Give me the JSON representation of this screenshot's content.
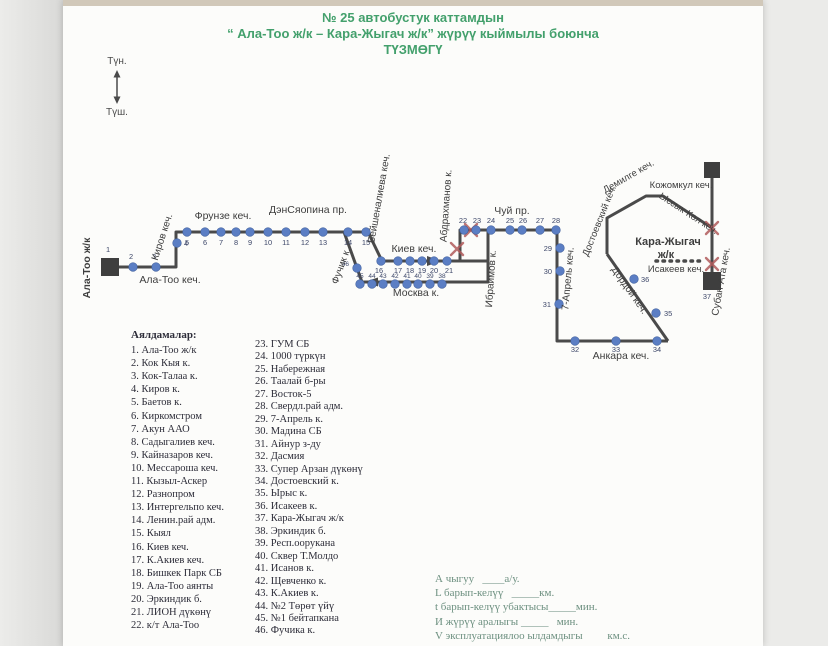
{
  "title": {
    "line1": "№ 25  автобустук каттамдын",
    "line2": "“ Ала-Тоо ж/к – Кара-Жыгач ж/к” жүрүү кыймылы боюнча",
    "line3": "ТҮЗМӨГҮ"
  },
  "compass": {
    "north": "Түн.",
    "south": "Түш."
  },
  "map": {
    "line_color": "#4a4a4a",
    "stop_fill": "#5b7ec4",
    "stop_stroke": "#41619e",
    "x_color": "#b05a5a",
    "number_color": "#3c4668",
    "label_color": "#3e3e3e",
    "routes": [
      "110,267 176,267 176,232 368,232 382,261 488,261",
      "460,261 460,230 557,230 557,341 668,341",
      "488,230 488,282 362,282 344,232",
      "668,341 607,254",
      "607,254 607,218 646,196 663,196 712,228",
      "712,176 712,281"
    ],
    "dashed": "656,261 704,261",
    "squares": [
      [
        101,
        258,
        18
      ],
      [
        704,
        162,
        16
      ],
      [
        703,
        272,
        18
      ]
    ],
    "arrows": [
      "427,256 427,266 441,261",
      "378,277.5 378,286.5 364,282"
    ],
    "xmarks": [
      [
        457,
        249
      ],
      [
        471,
        230
      ],
      [
        712,
        228
      ],
      [
        712,
        264
      ]
    ],
    "stops": [
      [
        2,
        133,
        267,
        131,
        259,
        "m"
      ],
      [
        3,
        156,
        267,
        154,
        259,
        "m"
      ],
      [
        4,
        177,
        243,
        184,
        246,
        "s"
      ],
      [
        5,
        187,
        232,
        187,
        245,
        "m"
      ],
      [
        6,
        205,
        232,
        205,
        245,
        "m"
      ],
      [
        7,
        221,
        232,
        221,
        245,
        "m"
      ],
      [
        8,
        236,
        232,
        236,
        245,
        "m"
      ],
      [
        9,
        250,
        232,
        250,
        245,
        "m"
      ],
      [
        10,
        268,
        232,
        268,
        245,
        "m"
      ],
      [
        11,
        286,
        232,
        286,
        245,
        "m"
      ],
      [
        12,
        305,
        232,
        305,
        245,
        "m"
      ],
      [
        13,
        323,
        232,
        323,
        245,
        "m"
      ],
      [
        14,
        348,
        232,
        348,
        245,
        "m"
      ],
      [
        15,
        366,
        232,
        366,
        245,
        "m"
      ],
      [
        16,
        381,
        261,
        379,
        273,
        "m"
      ],
      [
        17,
        398,
        261,
        398,
        273,
        "m"
      ],
      [
        18,
        410,
        261,
        410,
        273,
        "m"
      ],
      [
        19,
        422,
        261,
        422,
        273,
        "m"
      ],
      [
        20,
        434,
        261,
        434,
        273,
        "m"
      ],
      [
        21,
        447,
        261,
        449,
        273,
        "m"
      ],
      [
        22,
        464,
        230,
        463,
        223,
        "m"
      ],
      [
        23,
        476,
        230,
        477,
        223,
        "m"
      ],
      [
        24,
        491,
        230,
        491,
        223,
        "m"
      ],
      [
        25,
        510,
        230,
        510,
        223,
        "m"
      ],
      [
        26,
        522,
        230,
        523,
        223,
        "m"
      ],
      [
        27,
        540,
        230,
        540,
        223,
        "m"
      ],
      [
        28,
        556,
        230,
        556,
        223,
        "m"
      ],
      [
        29,
        560,
        248,
        552,
        251,
        "e"
      ],
      [
        30,
        560,
        271,
        552,
        274,
        "e"
      ],
      [
        31,
        559,
        304,
        551,
        307,
        "e"
      ],
      [
        32,
        575,
        341,
        575,
        352,
        "m"
      ],
      [
        33,
        616,
        341,
        616,
        352,
        "m"
      ],
      [
        34,
        657,
        341,
        657,
        352,
        "m"
      ],
      [
        35,
        656,
        313,
        664,
        316,
        "s"
      ],
      [
        36,
        634,
        279,
        641,
        282,
        "s"
      ],
      [
        38,
        442,
        284,
        442,
        278,
        "m",
        6.5
      ],
      [
        39,
        430,
        284,
        430,
        278,
        "m",
        6.5
      ],
      [
        40,
        418,
        284,
        418,
        278,
        "m",
        6.5
      ],
      [
        41,
        407,
        284,
        407,
        278,
        "m",
        6.5
      ],
      [
        42,
        395,
        284,
        395,
        278,
        "m",
        6.5
      ],
      [
        43,
        383,
        284,
        383,
        278,
        "m",
        6.5
      ],
      [
        44,
        372,
        284,
        372,
        278,
        "m",
        6.5
      ],
      [
        45,
        360,
        284,
        360,
        278,
        "m",
        6.5
      ],
      [
        46,
        357,
        268,
        349,
        266,
        "e",
        6.5
      ]
    ],
    "terminal_numbers": [
      [
        1,
        108,
        252
      ],
      [
        37,
        707,
        299
      ]
    ],
    "street_labels": [
      [
        "Ала-Тоо ж/к",
        90,
        268,
        -90,
        10.5,
        1
      ],
      [
        "Ала-Тоо кеч.",
        170,
        283,
        0,
        10.5,
        0
      ],
      [
        "Киров кеч.",
        165,
        238,
        -72,
        10,
        0
      ],
      [
        "Фрунзе кеч.",
        223,
        219,
        0,
        10.5,
        0
      ],
      [
        "ДэнСяопина пр.",
        308,
        213,
        0,
        10.5,
        0
      ],
      [
        "Бейшеналиева кеч.",
        382,
        199,
        -80,
        10,
        0
      ],
      [
        "Фучик к.",
        344,
        267,
        -70,
        10,
        0
      ],
      [
        "Киев кеч.",
        414,
        252,
        0,
        10.5,
        0
      ],
      [
        "Москва к.",
        416,
        296,
        0,
        10.5,
        0
      ],
      [
        "Абдрахманов к.",
        449,
        206,
        -86,
        10,
        0
      ],
      [
        "Ибраимов к.",
        494,
        279,
        -86,
        10,
        0
      ],
      [
        "Чуй пр.",
        512,
        214,
        0,
        10.5,
        0
      ],
      [
        "7-Апрель кеч.",
        571,
        279,
        -85,
        10,
        0
      ],
      [
        "Анкара кеч.",
        621,
        359,
        0,
        10.5,
        0
      ],
      [
        "Дордой кеч.",
        627,
        292,
        55,
        10,
        0
      ],
      [
        "Достоевский кеч.",
        602,
        222,
        -68,
        9.5,
        0
      ],
      [
        "Демилге кеч.",
        630,
        179,
        -30,
        9.5,
        0
      ],
      [
        "Кожомкул кеч.",
        681,
        188,
        0,
        9.5,
        0
      ],
      [
        "Ыссык-Көл кеч.",
        687,
        216,
        33,
        9.5,
        0
      ],
      [
        "Субан-Ата кеч.",
        724,
        282,
        -80,
        10,
        0
      ],
      [
        "Исакеев кеч.",
        676,
        272,
        0,
        9.5,
        0
      ],
      [
        "Кара-Жыгач",
        668,
        245,
        0,
        11,
        1
      ],
      [
        "ж/к",
        666,
        258,
        0,
        11,
        1
      ]
    ]
  },
  "stops_list": {
    "header": "Аялдамалар:",
    "col1": [
      "1.  Ала-Тоо ж/к",
      "2.  Кок Кыя к.",
      "3.  Кок-Талаа к.",
      "4.  Киров к.",
      "5.  Баетов к.",
      "6.  Киркомстром",
      "7.  Акун ААО",
      "8.  Садыгалиев кеч.",
      "9.  Кайназаров кеч.",
      "10.  Мессароша кеч.",
      "11.  Кызыл-Аскер",
      "12.  Разнопром",
      "13.  Интергельпо кеч.",
      "14.  Ленин.рай адм.",
      "15.  Кыял",
      "16.  Киев кеч.",
      "17.  К.Акиев кеч.",
      "18.  Бишкек Парк СБ",
      "19.  Ала-Тоо аянты",
      "20.  Эркиндик б.",
      "21.  ЛИОН дүкөнү",
      "22.  к/т Ала-Тоо"
    ],
    "col2": [
      "23.  ГУМ СБ",
      "24.  1000 түркүн",
      "25.  Набережная",
      "26.  Таалай б-ры",
      "27.  Восток-5",
      "28.  Свердл.рай адм.",
      "29.  7-Апрель к.",
      "30.  Мадина СБ",
      "31.  Айнур з-ду",
      "32.  Дасмия",
      "33.  Супер Арзан дүкөнү",
      "34.  Достоевский к.",
      "35.  Ырыс к.",
      "36.  Исакеев к.",
      "37.  Кара-Жыгач ж/к",
      "38.  Эркиндик б.",
      "39.  Респ.оорукана",
      "40.  Сквер Т.Молдо",
      "41.  Исанов к.",
      "42.  Щевченко к.",
      "43.  К.Акиев к.",
      "44.  №2 Төрөт үйү",
      "45.  №1 бейтапкана",
      "46.  Фучика к."
    ]
  },
  "footer_form": {
    "lines": [
      "А чыгуу   ____а/у.",
      "L барып-келүү   _____км.",
      "t барып-келүү убактысы_____мин.",
      "И жүрүү аралыгы _____   мин.",
      "V эксплуатациялоо ылдамдыгы         км.с."
    ]
  }
}
